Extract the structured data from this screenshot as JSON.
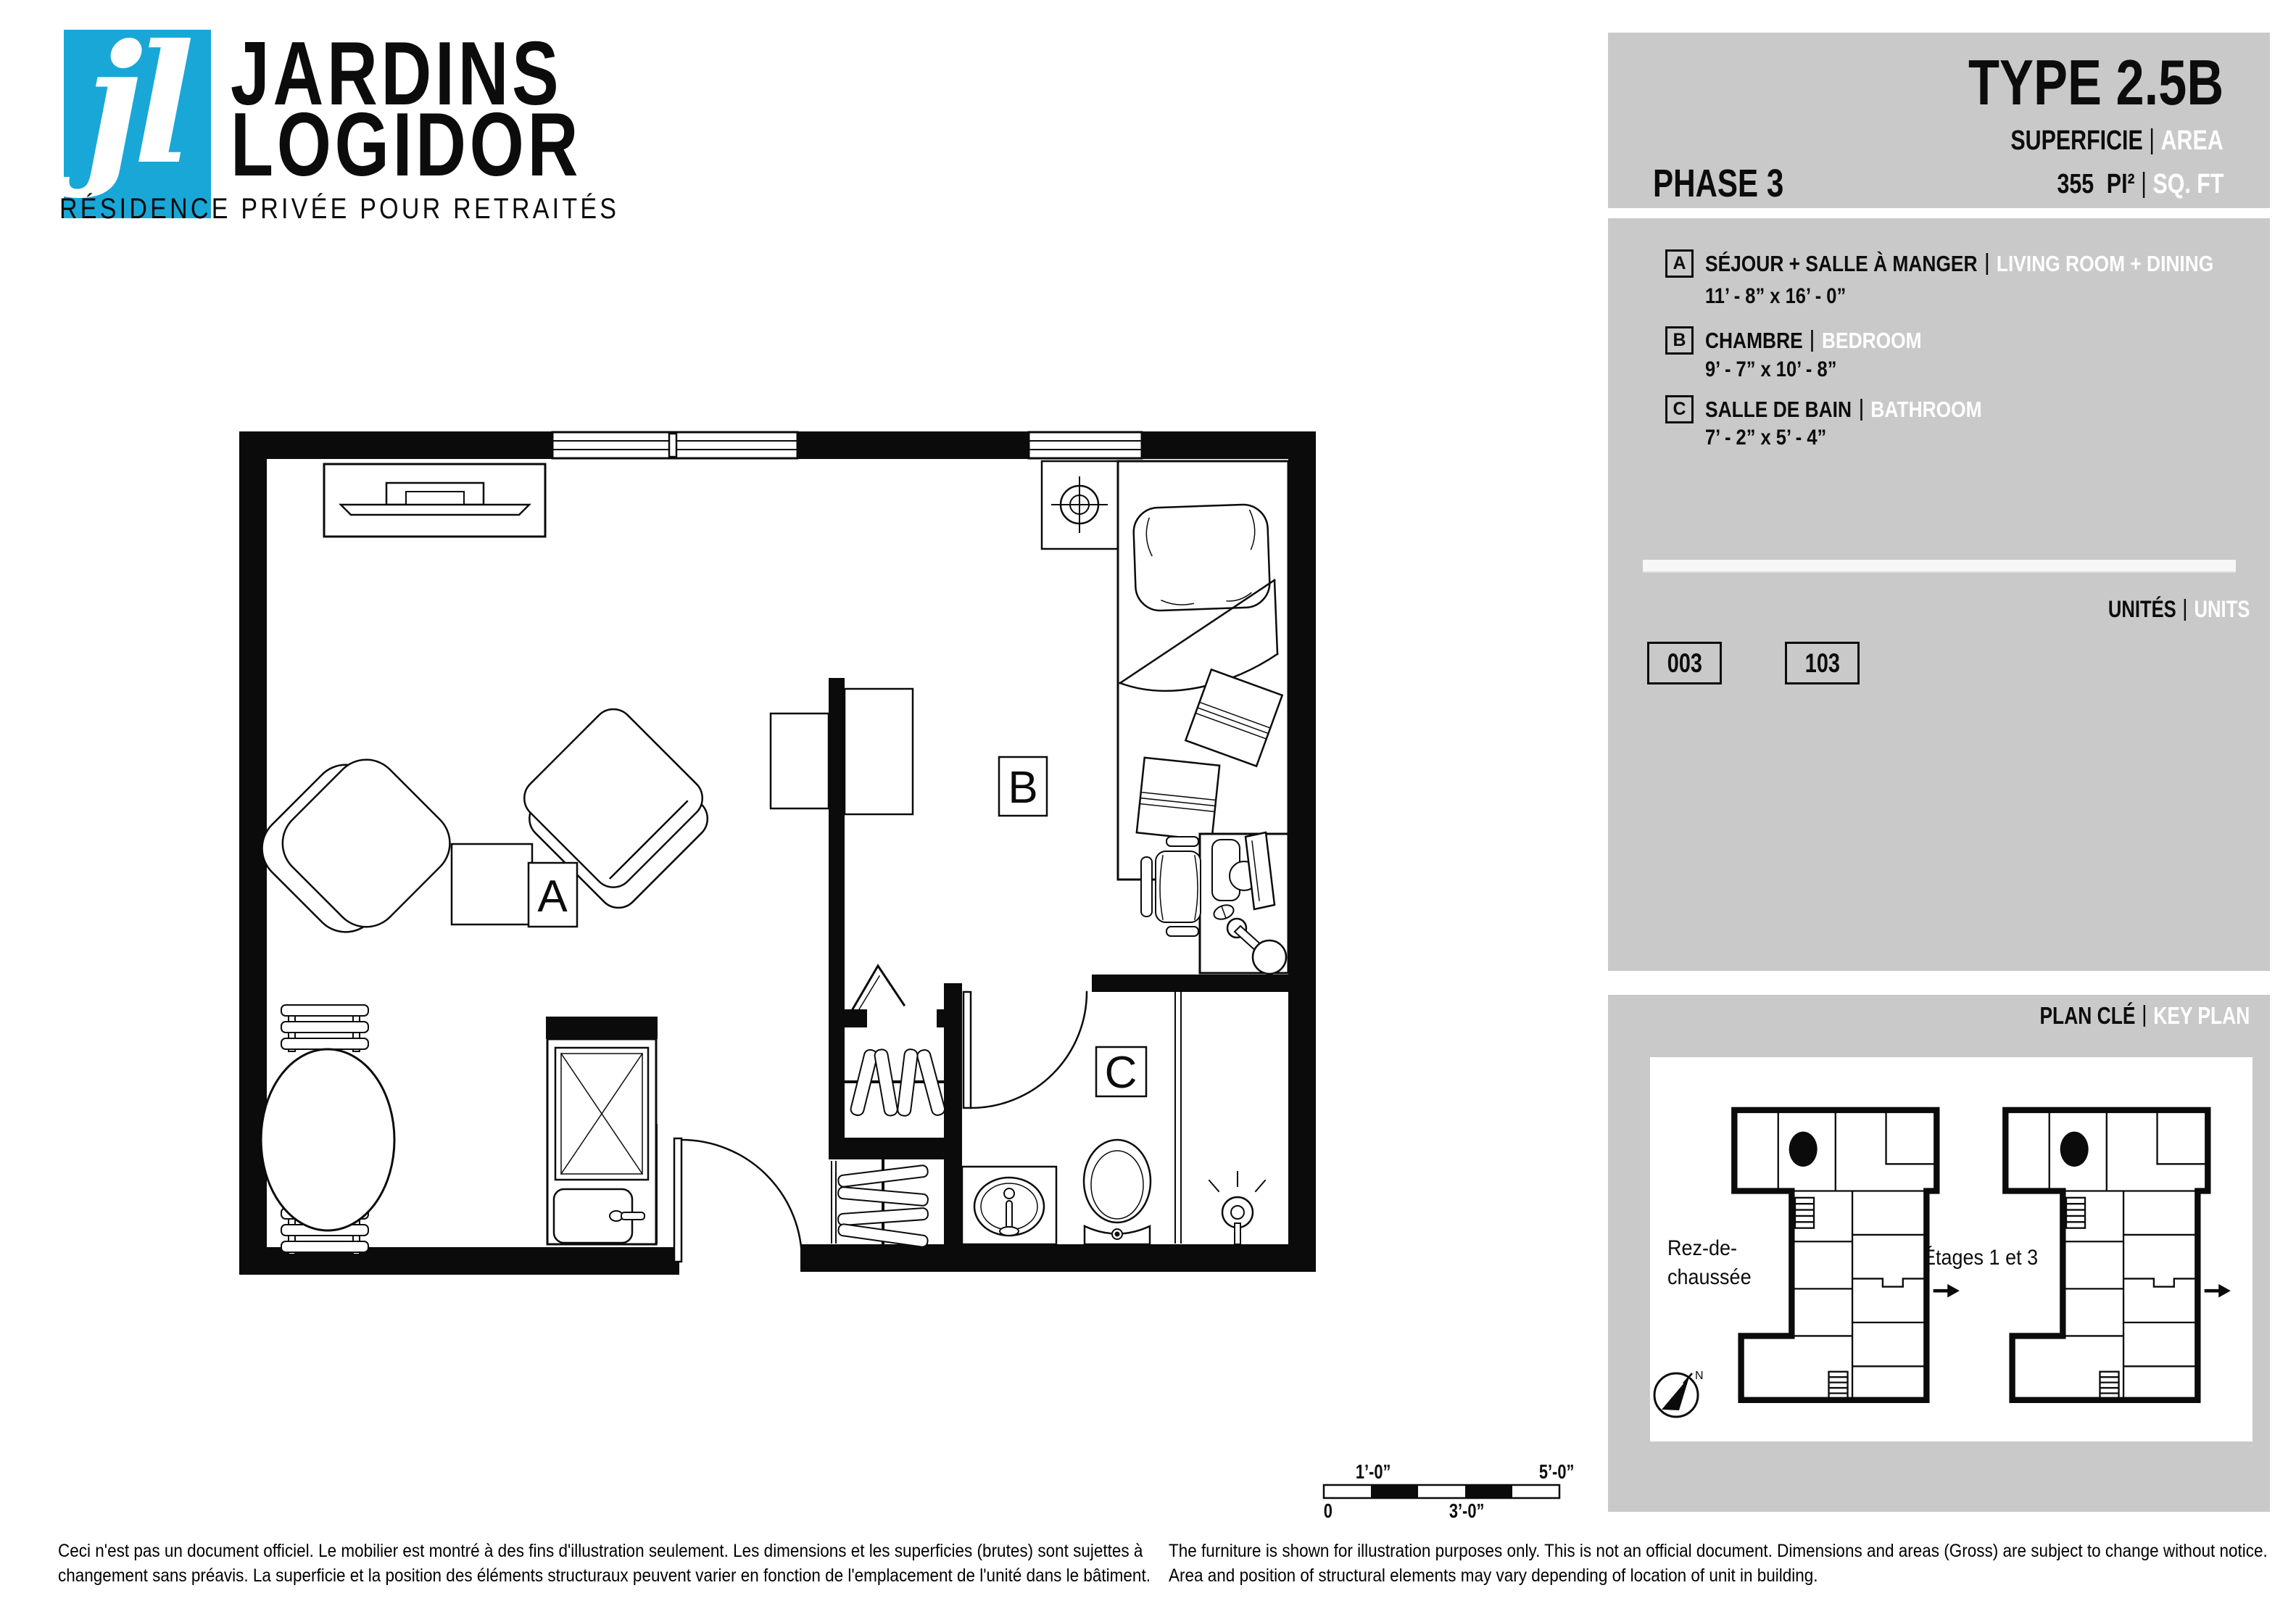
{
  "brand": {
    "monogram": "jl",
    "line1": "JARDINS",
    "line2": "LOGIDOR",
    "tagline": "RÉSIDENCE PRIVÉE POUR RETRAITÉS"
  },
  "header": {
    "phase": "PHASE 3",
    "type": "TYPE 2.5B",
    "superficie": "SUPERFICIE",
    "area": "AREA",
    "area_value": "355",
    "area_unit_fr": "PI²",
    "area_unit_en": "SQ. FT"
  },
  "legend": {
    "rooms": [
      {
        "key": "A",
        "fr": "SÉJOUR + SALLE À MANGER",
        "en": "LIVING ROOM + DINING",
        "dims": "11’ - 8” x 16’ - 0”"
      },
      {
        "key": "B",
        "fr": "CHAMBRE",
        "en": "BEDROOM",
        "dims": "9’ -  7” x 10’ -  8”"
      },
      {
        "key": "C",
        "fr": "SALLE DE BAIN",
        "en": "BATHROOM",
        "dims": "7’ -  2” x 5’ -  4”"
      }
    ]
  },
  "units": {
    "fr": "UNITÉS",
    "en": "UNITS",
    "numbers": [
      "003",
      "103"
    ]
  },
  "key_plan": {
    "fr": "PLAN CLÉ",
    "en": "KEY PLAN",
    "floor1_line1": "Rez-de-",
    "floor1_line2": "chaussée",
    "floor2": "Étages 1 et 3",
    "compass_n": "N"
  },
  "floor_plan": {
    "labels": [
      "A",
      "B",
      "C"
    ]
  },
  "scale_bar": {
    "above_left": "1’-0”",
    "above_right": "5’-0”",
    "below_left": "0",
    "below_mid": "3’-0”"
  },
  "disclaimers": {
    "fr": [
      "Ceci n'est pas un document officiel. Le mobilier est montré à des fins d'illustration seulement. Les dimensions et les superficies (brutes) sont sujettes à",
      "changement sans préavis. La superficie et la position des éléments structuraux peuvent varier en fonction de l'emplacement de l'unité dans le bâtiment."
    ],
    "en": [
      "The furniture is shown for illustration purposes only. This is not an official document. Dimensions and areas (Gross) are subject to change without notice.",
      "Area and position of structural elements may vary depending of location of unit in building."
    ]
  },
  "colors": {
    "accent": "#19a7d8",
    "panel": "#c9c9c9",
    "ink": "#0c0c0c",
    "white": "#ffffff"
  }
}
